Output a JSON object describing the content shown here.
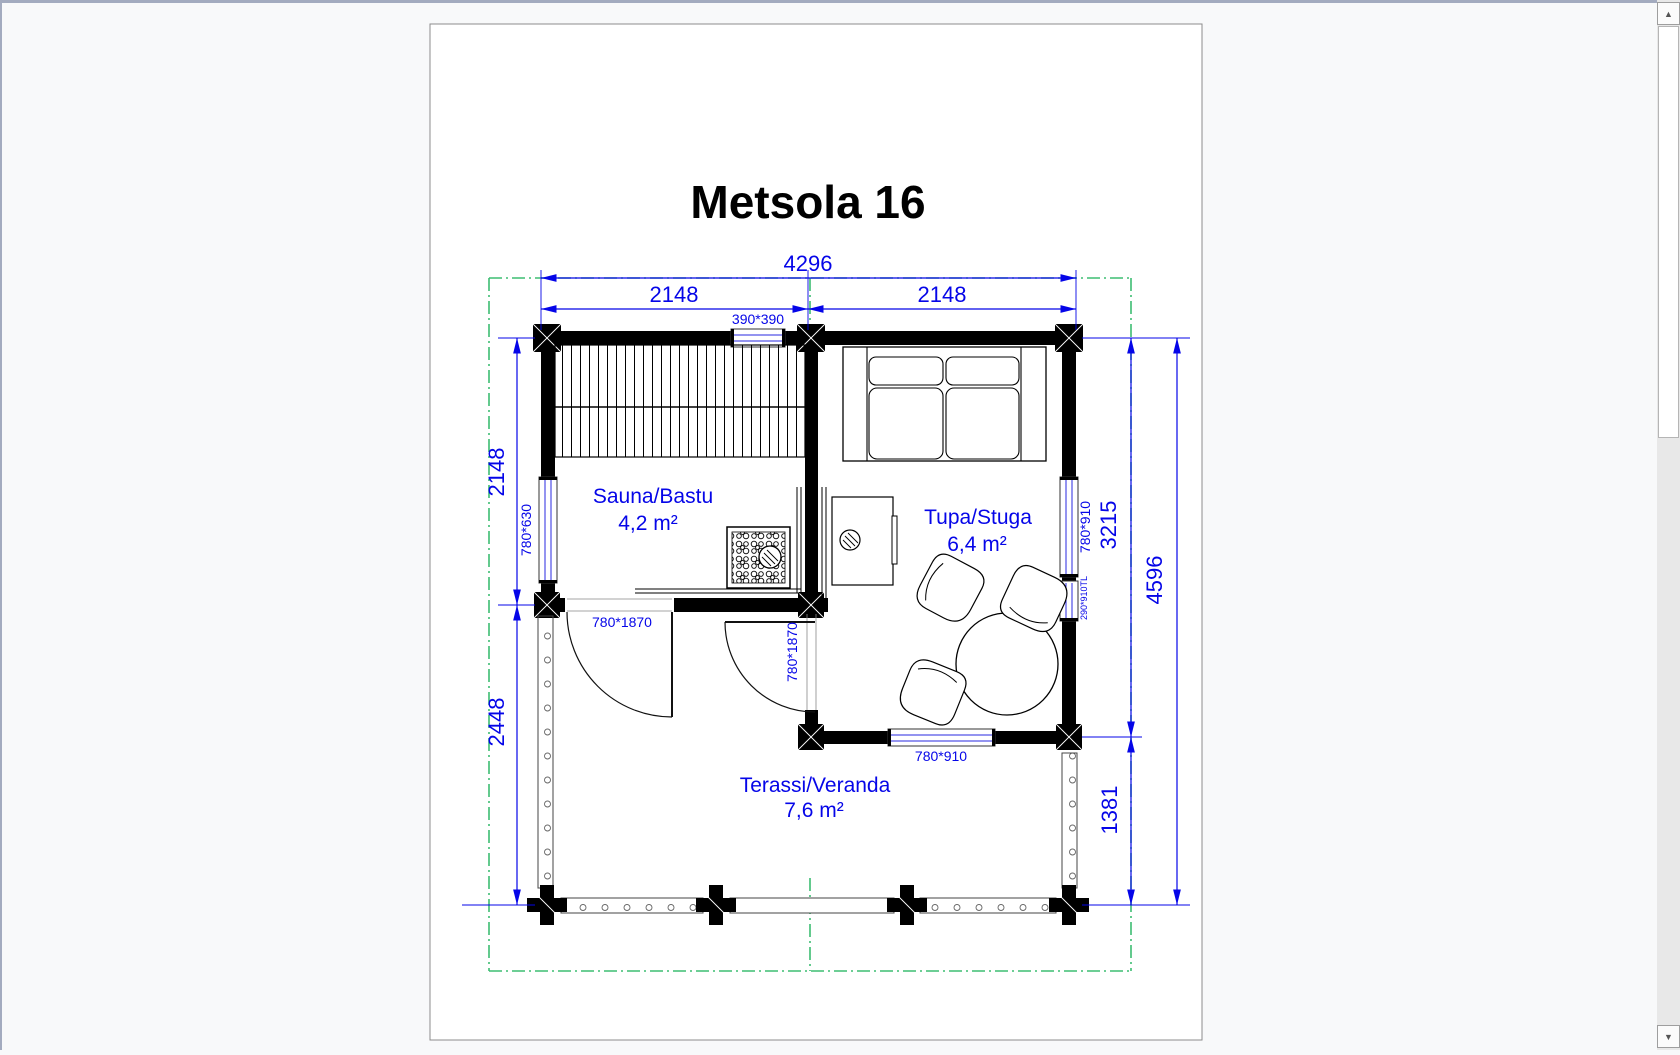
{
  "drawing": {
    "title": "Metsola 16",
    "rooms": [
      {
        "name": "Sauna/Bastu",
        "area": "4,2 m²"
      },
      {
        "name": "Tupa/Stuga",
        "area": "6,4 m²"
      },
      {
        "name": "Terassi/Veranda",
        "area": "7,6 m²"
      }
    ],
    "dimensions": {
      "total_width": "4296",
      "width_left": "2148",
      "width_right": "2148",
      "sauna_depth": "2148",
      "veranda_depth": "2448",
      "living_height": "3215",
      "total_height": "4596",
      "veranda_height": "1381"
    },
    "openings": {
      "top_window": "390*390",
      "left_window": "780*630",
      "right_window": "780*910",
      "right_small_window": "290*910TL",
      "bottom_window": "780*910",
      "sauna_door": "780*1870",
      "living_door": "780*1870"
    },
    "colors": {
      "dimension_blue": "#0505e8",
      "boundary_green": "#3dbd72",
      "wall_black": "#000000",
      "page_white": "#ffffff",
      "canvas_gray": "#f8f9fa"
    }
  },
  "scrollbar": {
    "up_glyph": "▲",
    "down_glyph": "▼"
  }
}
